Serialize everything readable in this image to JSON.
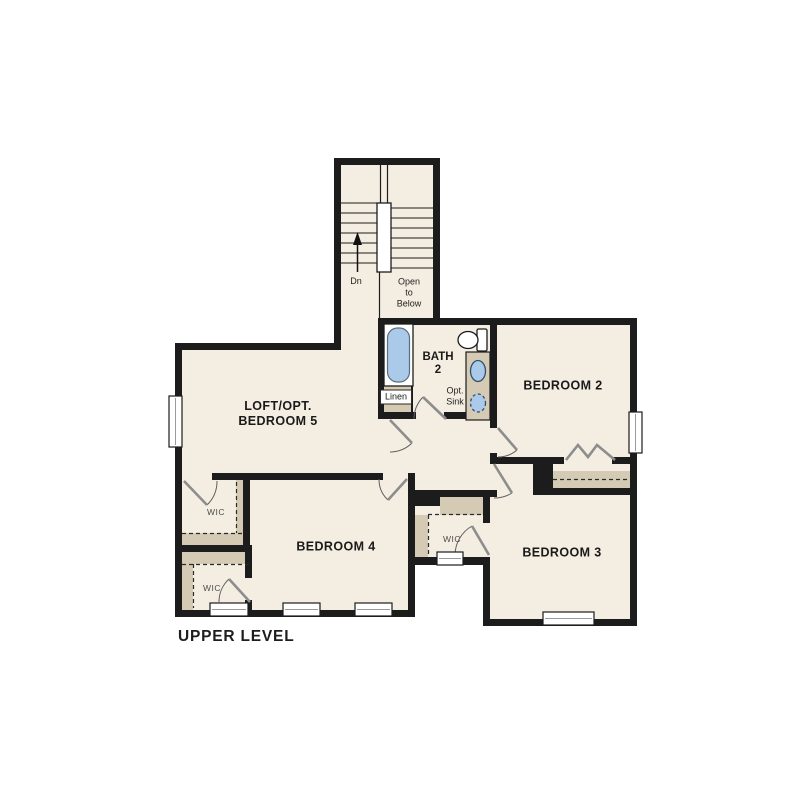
{
  "plan": {
    "level_label": "UPPER LEVEL",
    "rooms": {
      "loft": {
        "label_line1": "LOFT/OPT.",
        "label_line2": "BEDROOM 5"
      },
      "bedroom2": {
        "label": "BEDROOM 2"
      },
      "bedroom3": {
        "label": "BEDROOM 3"
      },
      "bedroom4": {
        "label": "BEDROOM 4"
      },
      "bath": {
        "label_line1": "BATH",
        "label_line2": "2"
      }
    },
    "stairs": {
      "down_label": "Dn",
      "open_line1": "Open",
      "open_line2": "to",
      "open_line3": "Below"
    },
    "closets": {
      "wic_loft": "WIC",
      "wic_bedroom4": "WIC",
      "wic_bedroom3": "WIC",
      "linen": "Linen"
    },
    "fixtures": {
      "opt_sink_line1": "Opt.",
      "opt_sink_line2": "Sink"
    },
    "colors": {
      "bg": "#ffffff",
      "room-fill": "#f4eee2",
      "wall": "#1c1c1c",
      "shelf": "#d5cab3",
      "fixture-blue": "#abc9e8"
    }
  }
}
